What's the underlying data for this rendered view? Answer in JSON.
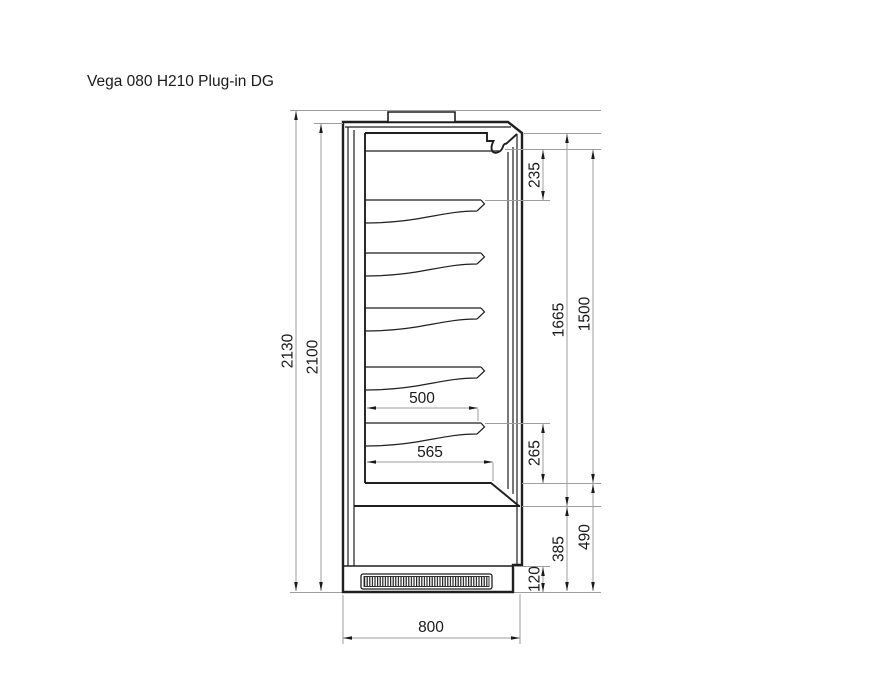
{
  "title": "Vega 080 H210 Plug-in DG",
  "drawing": {
    "shelf_count": 5,
    "dims": {
      "overall_height": "2130",
      "body_height": "2100",
      "canopy_to_first_shelf": "235",
      "interior_to_step": "1665",
      "interior_to_deck": "1500",
      "shelf_depth": "500",
      "deck_depth": "565",
      "last_shelf_to_deck": "265",
      "lower_section_height": "385",
      "deck_to_ground": "490",
      "plinth_height": "120",
      "overall_depth": "800"
    }
  }
}
